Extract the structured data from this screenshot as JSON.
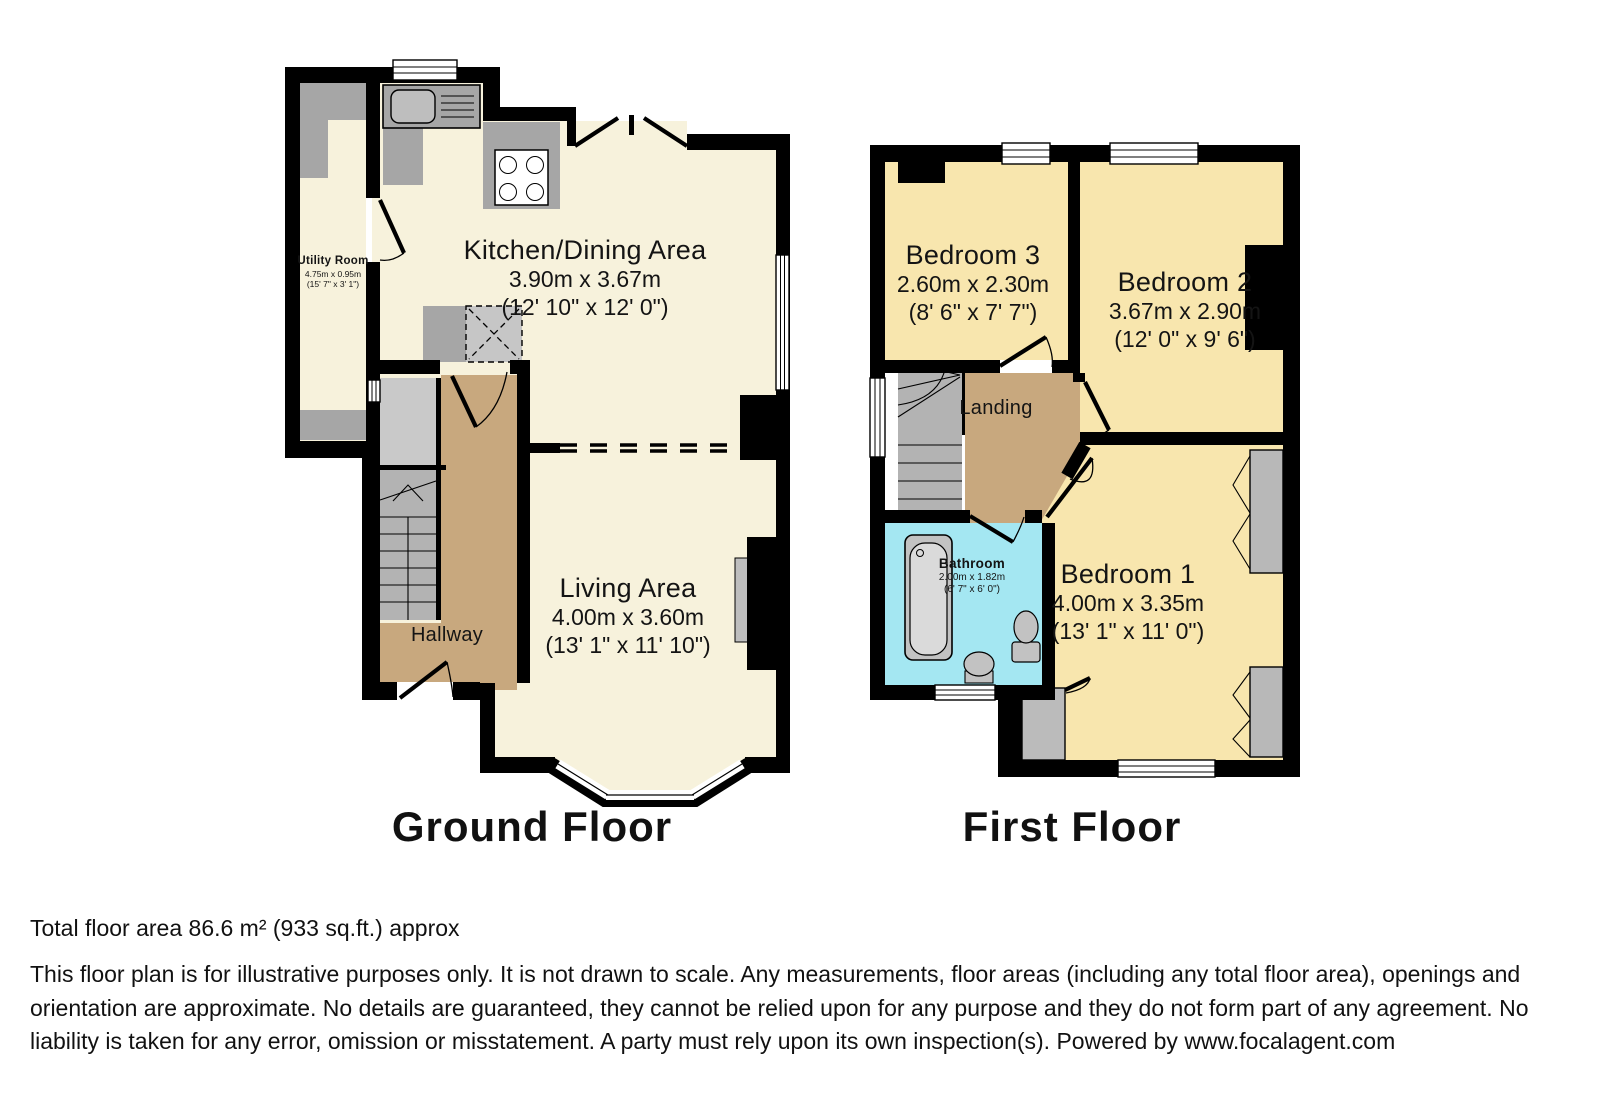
{
  "ground_floor": {
    "title": "Ground Floor",
    "rooms": {
      "utility": {
        "name": "Utility Room",
        "metric": "4.75m x 0.95m",
        "imperial": "(15' 7\" x 3' 1\")"
      },
      "kitchen": {
        "name": "Kitchen/Dining Area",
        "metric": "3.90m x 3.67m",
        "imperial": "(12' 10\" x 12' 0\")"
      },
      "living": {
        "name": "Living Area",
        "metric": "4.00m x 3.60m",
        "imperial": "(13' 1\" x 11' 10\")"
      },
      "hallway": {
        "name": "Hallway"
      }
    }
  },
  "first_floor": {
    "title": "First Floor",
    "rooms": {
      "bedroom3": {
        "name": "Bedroom 3",
        "metric": "2.60m x 2.30m",
        "imperial": "(8' 6\" x 7' 7\")"
      },
      "bedroom2": {
        "name": "Bedroom 2",
        "metric": "3.67m x 2.90m",
        "imperial": "(12' 0\" x 9' 6\")"
      },
      "bedroom1": {
        "name": "Bedroom 1",
        "metric": "4.00m x 3.35m",
        "imperial": "(13' 1\" x 11' 0\")"
      },
      "landing": {
        "name": "Landing"
      },
      "bathroom": {
        "name": "Bathroom",
        "metric": "2.00m x 1.82m",
        "imperial": "(6' 7\" x 6' 0\")"
      }
    }
  },
  "footer": {
    "total_area": "Total floor area 86.6 m² (933 sq.ft.) approx",
    "disclaimer": "This floor plan is for illustrative purposes only. It is not drawn to scale. Any measurements, floor areas (including any total floor area), openings and orientation are approximate. No details are guaranteed, they cannot be relied upon for any purpose and they do not form part of any agreement. No liability is taken for any error, omission or misstatement. A party must rely upon its own inspection(s). Powered by www.focalagent.com"
  },
  "colors": {
    "cream": "#F7F2DC",
    "yellow": "#F8E6AE",
    "tan": "#C8A87E",
    "bathblue": "#A4E7F2",
    "cgray": "#A6A6A6",
    "wall": "#000000"
  }
}
